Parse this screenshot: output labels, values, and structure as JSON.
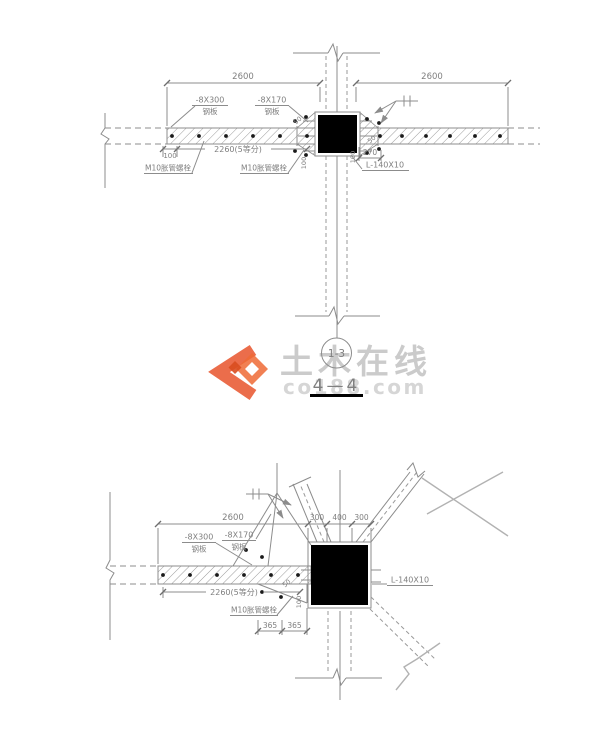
{
  "colors": {
    "line": "#8c8c8c",
    "text": "#7f7f7f",
    "column_fill": "#000000",
    "break_line": "#b2b2b2",
    "watermark_orange": "#e8542c",
    "watermark_orange_light": "#ef6a35",
    "watermark_orange_dark": "#d94d1f",
    "watermark_text_gray": "#cbcbcb"
  },
  "watermark": {
    "brand": "土木在线",
    "domain": "co188.com"
  },
  "section_marker": {
    "bubble_label": "1-3",
    "title": "4—4"
  },
  "top_drawing": {
    "dim_span_left": "2600",
    "dim_span_right": "2600",
    "label_plate_300": "-8X300",
    "label_plate_300_sub": "钢板",
    "label_plate_170": "-8X170",
    "label_plate_170_sub": "钢板",
    "dim_edge_offset": "100",
    "dim_bolt_spacing": "2260(5等分)",
    "label_bolt_left": "M10胀管螺栓",
    "label_bolt_mid": "M10胀管螺栓",
    "dim_col_offset": "270",
    "label_angle": "L-140X10",
    "dim_small_left": "100",
    "dim_small_right": "100",
    "dim_diag_left": "50",
    "dim_diag_right": "50"
  },
  "bottom_drawing": {
    "dim_span": "2600",
    "dim_col_left": "300",
    "dim_col_mid": "400",
    "dim_col_right": "300",
    "label_plate_300": "-8X300",
    "label_plate_300_sub": "钢板",
    "label_plate_170": "-8X170",
    "label_plate_170_sub": "钢板",
    "dim_bolt_spacing": "2260(5等分)",
    "label_bolt": "M10胀管螺栓",
    "dim_365_left": "365",
    "dim_365_right": "365",
    "dim_small": "100",
    "dim_diag": "50",
    "label_angle": "L-140X10"
  }
}
